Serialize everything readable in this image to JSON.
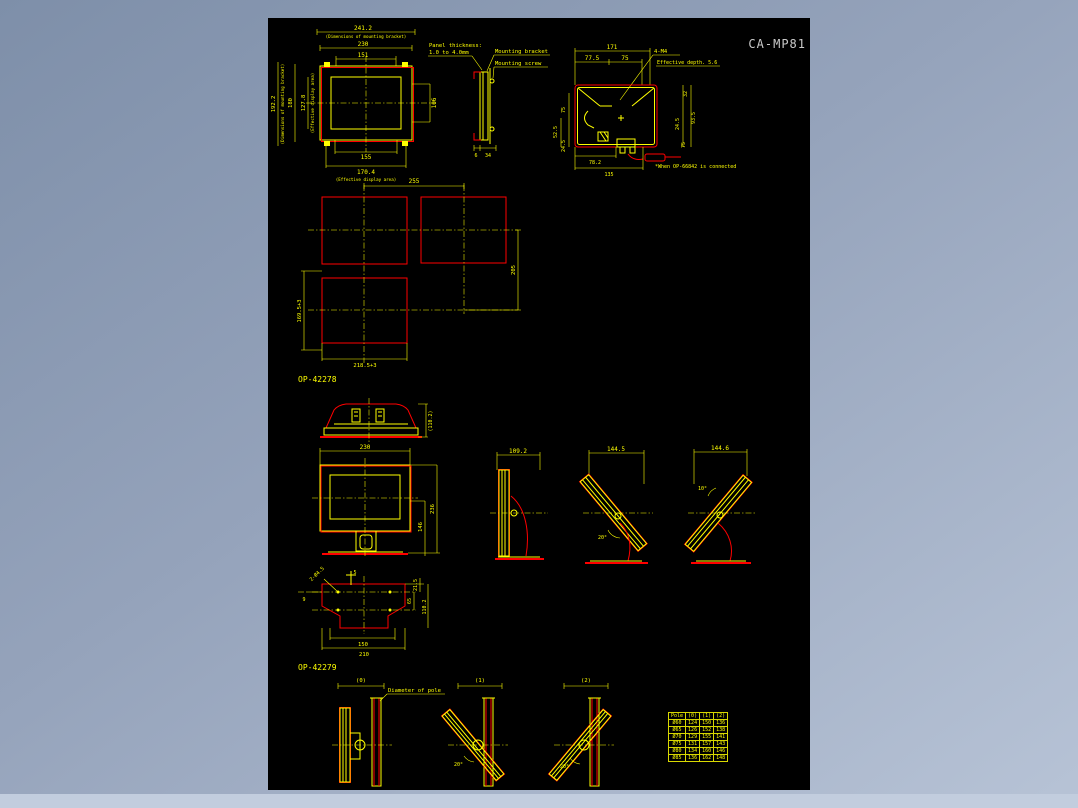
{
  "window": {
    "title": "CA-MP81"
  },
  "colors": {
    "line": "#ffff00",
    "accent": "#ff0000",
    "canvas_bg": "#000000",
    "title_text": "#c9c9c9"
  },
  "front_view": {
    "dim_241": "241.2",
    "note_241": "(Dimensions of mounting bracket)",
    "dim_230": "230",
    "dim_151": "151",
    "dim_192": "192.2",
    "note_192": "(Dimensions of mounting bracket)",
    "dim_180": "180",
    "dim_127": "127.8",
    "note_127": "(Effective display area)",
    "dim_106": "106",
    "dim_155": "155",
    "dim_170": "170.4",
    "note_170": "(Effective display area)"
  },
  "side_view": {
    "panel_thickness_line1": "Panel thickness:",
    "panel_thickness_line2": "1.0 to 4.0mm",
    "mounting_bracket": "Mounting bracket",
    "mounting_screw": "Mounting screw",
    "dim_6": "6",
    "dim_34": "34"
  },
  "rear_view": {
    "dim_171": "171",
    "dim_77_5": "77.5",
    "dim_75_top": "75",
    "label_4m4": "4-M4",
    "label_depth": "Effective depth. 5.6",
    "dim_75_left": "75",
    "dim_52_5": "52.5",
    "dim_24_5_left": "24.5",
    "dim_78_2": "78.2",
    "dim_135": "135",
    "dim_32": "32",
    "dim_24_5_right": "24.5",
    "dim_93_5": "93.5",
    "dim_75_right": "75",
    "note": "*When OP-66842 is connected"
  },
  "cutout_view": {
    "dim_255": "255",
    "dim_205": "205",
    "dim_169": "169.5+3",
    "dim_218": "218.5+3"
  },
  "op4227s": {
    "label": "OP-42278",
    "dim_110": "(110.2)"
  },
  "stand_front": {
    "dim_230": "230",
    "dim_236": "236",
    "dim_146": "146"
  },
  "stand_side_views": [
    {
      "dim": "109.2",
      "angle": ""
    },
    {
      "dim": "144.5",
      "angle": "20°"
    },
    {
      "dim": "144.6",
      "angle": "10°"
    }
  ],
  "plate_view": {
    "holes": "2-Ø4.5",
    "dim_5": "5",
    "dim_9": "9",
    "dim_21_5": "21.5",
    "dim_65": "65",
    "dim_110_2": "110.2",
    "dim_150": "150",
    "dim_210": "210"
  },
  "op42279": {
    "label": "OP-42279",
    "pole_note": "Diameter of pole",
    "views": [
      {
        "tag": "(0)",
        "angle": ""
      },
      {
        "tag": "(1)",
        "angle": "20°"
      },
      {
        "tag": "(2)",
        "angle": "20°"
      }
    ]
  },
  "table": {
    "headers": [
      "Pole",
      "(0)",
      "(1)",
      "(2)"
    ],
    "rows": [
      [
        "Ø60",
        "124",
        "150",
        "136"
      ],
      [
        "Ø65",
        "126",
        "152",
        "138"
      ],
      [
        "Ø70",
        "129",
        "155",
        "141"
      ],
      [
        "Ø75",
        "131",
        "157",
        "143"
      ],
      [
        "Ø80",
        "134",
        "160",
        "146"
      ],
      [
        "Ø85",
        "136",
        "162",
        "148"
      ]
    ]
  }
}
